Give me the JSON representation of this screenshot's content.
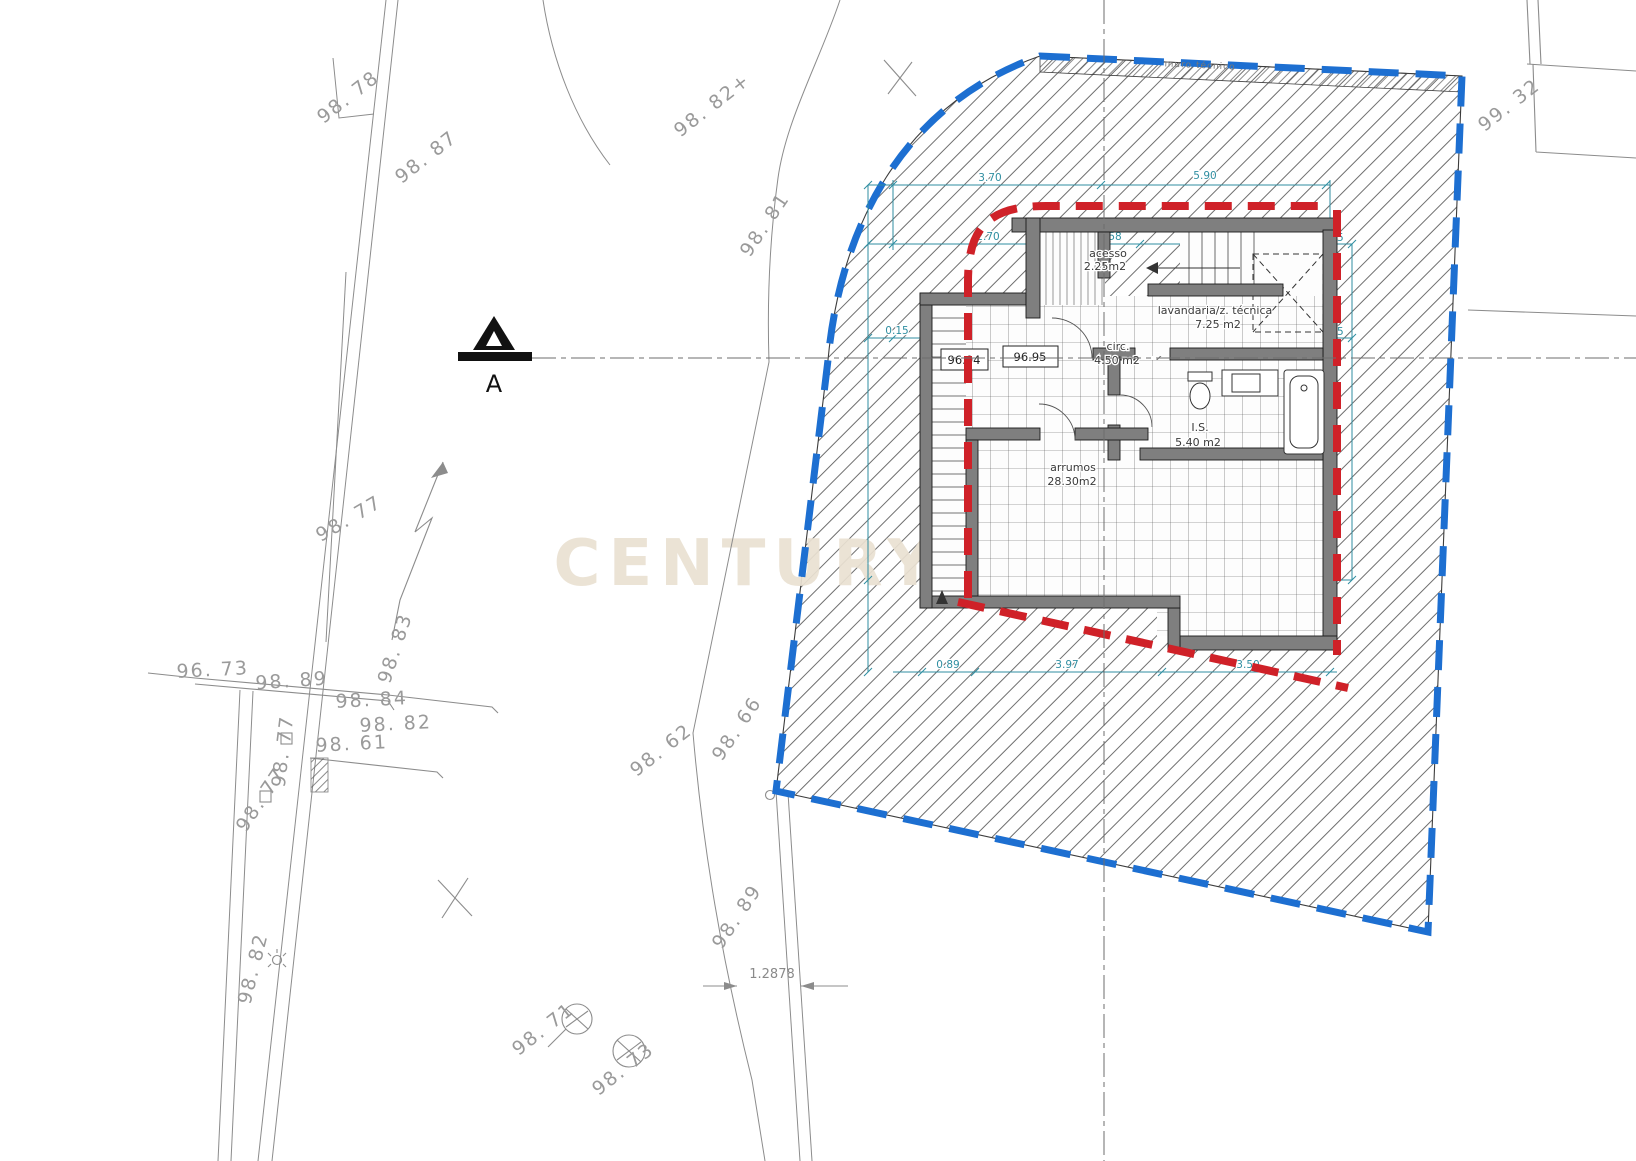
{
  "watermark": {
    "text": "CENTURY21"
  },
  "plot": {
    "wall_note": "muro técnico"
  },
  "section": {
    "label": "A"
  },
  "rooms": [
    {
      "name": "acesso",
      "area": "2.25m2"
    },
    {
      "name": "lavandaria/z. técnica",
      "area": "7.25 m2"
    },
    {
      "name": "circ.",
      "area": "4.50 m2"
    },
    {
      "name": "I.S.",
      "area": "5.40 m2"
    },
    {
      "name": "arrumos",
      "area": "28.30m2"
    }
  ],
  "levels": [
    "96.94",
    "96.95"
  ],
  "spot_elevations": [
    "98. 78",
    "98. 87",
    "98. 82+",
    "98. 81",
    "99. 32",
    "98. 77",
    "98. 83",
    "96. 73",
    "98. 89",
    "98. 84",
    "98. 82",
    "98. 61",
    "98. 77",
    "98. 77",
    "98. 82",
    "98. 62",
    "98. 66",
    "98. 89",
    "98. 71",
    "98. 73"
  ],
  "dimensions": [
    "3.70",
    "5.90",
    "2.70",
    "0.35",
    "1.58",
    "3.52",
    "0.35",
    "0.15",
    "1.03",
    "0.35",
    "3.02",
    "3.55",
    "0.35",
    "6.87",
    "0.35",
    "3.96",
    "2.91",
    "0.89",
    "3.97",
    "3.50",
    "1.45"
  ],
  "offset_dimension": "1.2878",
  "colors": {
    "plot_boundary": "#1d6fd1",
    "building_envelope": "#cf2128",
    "dimension_lines": "#2f8ea1",
    "watermark": "#eae1d2"
  }
}
